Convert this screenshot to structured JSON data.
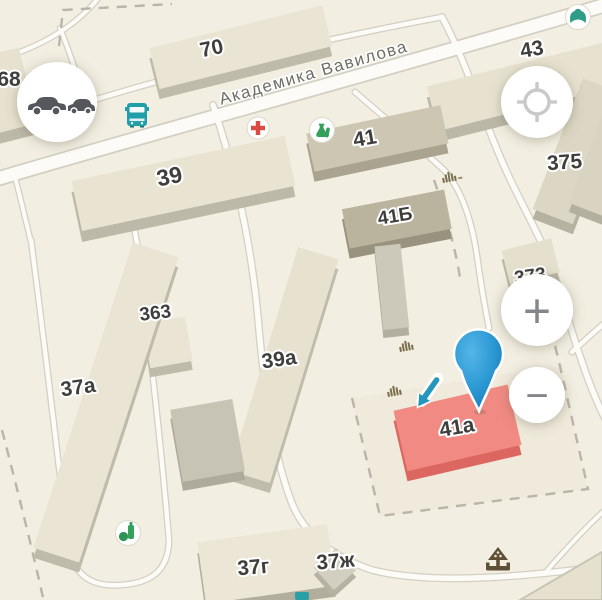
{
  "map": {
    "street_label": "Академика Вавилова",
    "buildings": {
      "b68": "68",
      "b70": "70",
      "b43": "43",
      "b39": "39",
      "b41": "41",
      "b41b": "41Б",
      "b375": "375",
      "b373": "373",
      "b363": "363",
      "b39a": "39а",
      "b37a": "37а",
      "b41a": "41а",
      "b37g": "37г",
      "b37zh": "37ж"
    },
    "highlight": {
      "building": "41а",
      "fill": "#f18a82"
    },
    "icons": {
      "traffic": "two-cars-traffic",
      "bus_stop": "bus-front",
      "medical": "red-cross",
      "pharmacy": "green-flasks",
      "grocery": "green-bottle-and-fruit",
      "poi_green": "green-figure",
      "antenna": "signal-bars",
      "fountain": "fountain-monument",
      "locate": "crosshair-target",
      "entrance_arrow": "blue-arrow-down-right",
      "pin": "map-pin-balloon"
    }
  },
  "controls": {
    "zoom_in_glyph": "+",
    "zoom_out_glyph": "−"
  },
  "colors": {
    "background": "#f2eee1",
    "road_fill": "#fcfbf7",
    "road_casing": "#d3cfc3",
    "building_top": "#e9e4d3",
    "building_side": "#bdb9a9",
    "highlight_top": "#f18a82",
    "highlight_side": "#dc6760",
    "label": "#3e3e3c",
    "street_label": "#6e6e68",
    "bus_teal": "#1f9fa8",
    "medical_red": "#dc4b40",
    "poi_green": "#33a05c",
    "pin_blue": "#2d9ad4",
    "arrow_teal": "#2596be"
  }
}
